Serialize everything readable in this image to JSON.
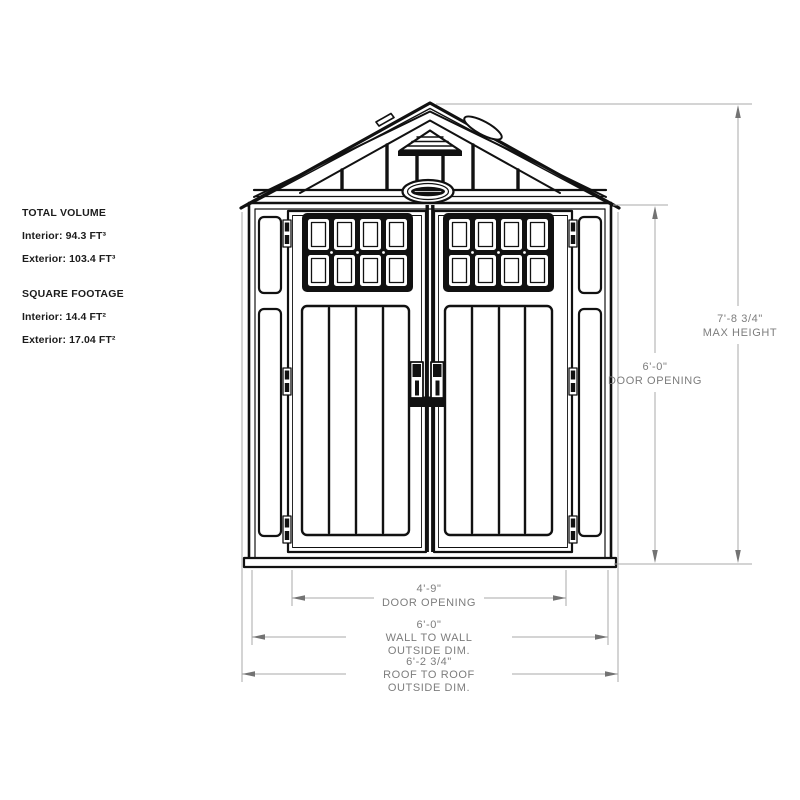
{
  "info_panel": {
    "total_volume": {
      "heading": "TOTAL VOLUME",
      "interior": "Interior: 94.3 FT³",
      "exterior": "Exterior: 103.4 FT³"
    },
    "square_footage": {
      "heading": "SQUARE FOOTAGE",
      "interior": "Interior: 14.4 FT²",
      "exterior": "Exterior: 17.04 FT²"
    }
  },
  "dimensions": {
    "max_height": {
      "value": "7'-8 3/4\"",
      "label": "MAX HEIGHT"
    },
    "door_opening_height": {
      "value": "6'-0\"",
      "label": "DOOR OPENING"
    },
    "door_opening_width": {
      "value": "4'-9\"",
      "label": "DOOR OPENING"
    },
    "wall_to_wall": {
      "value": "6'-0\"",
      "label": "WALL TO WALL",
      "sublabel": "OUTSIDE DIM."
    },
    "roof_to_roof": {
      "value": "6'-2 3/4\"",
      "label": "ROOF TO ROOF",
      "sublabel": "OUTSIDE DIM."
    }
  },
  "colors": {
    "drawing_line": "#111111",
    "dimension_line": "#a8a8a8",
    "dimension_arrow": "#737373",
    "dimension_text": "#7d7d7d",
    "background": "#ffffff"
  }
}
